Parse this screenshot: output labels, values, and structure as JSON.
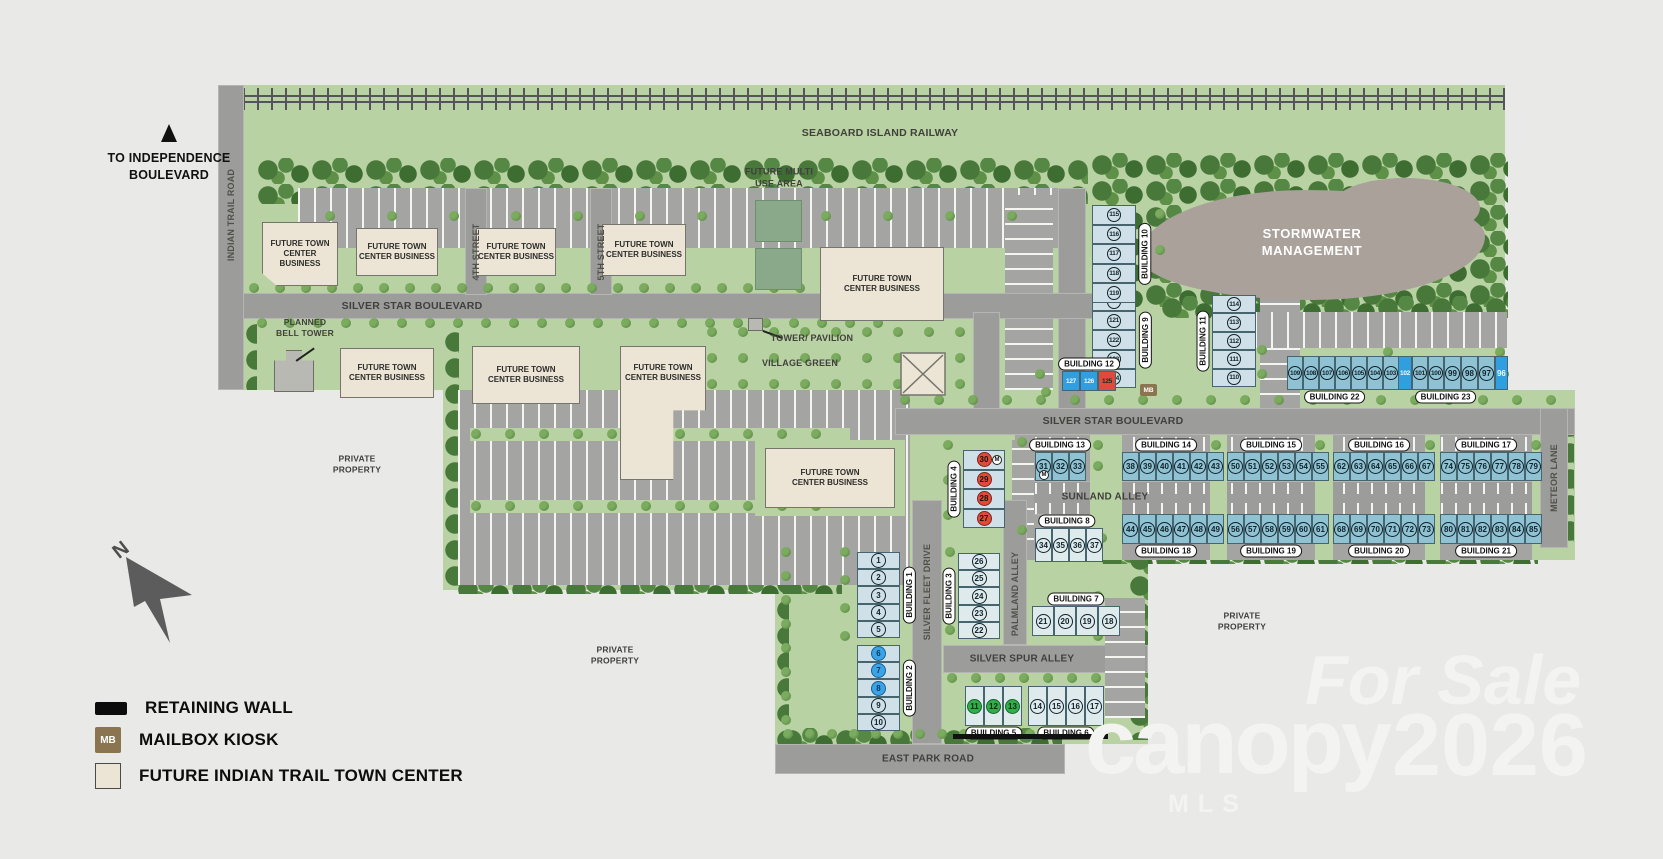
{
  "map": {
    "north_letter": "N",
    "m_marker": "M",
    "mb_abbr": "MB",
    "to_independence_line1": "TO INDEPENDENCE",
    "to_independence_line2": "BOULEVARD",
    "railway": "SEABOARD ISLAND RAILWAY",
    "stormwater_line1": "STORMWATER",
    "stormwater_line2": "MANAGEMENT",
    "village_green": "VILLAGE GREEN",
    "tower_pavilion": "TOWER/ PAVILION",
    "future_multi_line1": "FUTURE MULTI",
    "future_multi_line2": "USE AREA",
    "planned_bell_line1": "PLANNED",
    "planned_bell_line2": "BELL TOWER",
    "future_business_line1": "FUTURE TOWN",
    "future_business_line2": "CENTER BUSINESS",
    "private_property_line1": "PRIVATE",
    "private_property_line2": "PROPERTY"
  },
  "roads": {
    "indian_trail": "INDIAN TRAIL ROAD",
    "silver_star": "SILVER STAR BOULEVARD",
    "fourth": "4TH STREET",
    "fifth": "5TH STREET",
    "sunland": "SUNLAND ALLEY",
    "silver_fleet": "SILVER FLEET DRIVE",
    "palmland": "PALMLAND ALLEY",
    "silver_spur": "SILVER SPUR ALLEY",
    "east_park": "EAST PARK ROAD",
    "meteor": "METEOR LANE"
  },
  "legend": {
    "retaining_wall": "RETAINING WALL",
    "mailbox_kiosk": "MAILBOX KIOSK",
    "future_center": "FUTURE INDIAN TRAIL TOWN CENTER"
  },
  "watermark": {
    "for_sale": "For Sale",
    "brand": "canopy",
    "mls": "MLS",
    "year": "2026"
  },
  "colors": {
    "background": "#e9e9e7",
    "site_green": "#b9d2a3",
    "road_gray": "#9c9c9a",
    "building_beige": "#ece5d5",
    "lot_teal": "#8fc2d3",
    "lot_light_blue": "#cfe0e8",
    "highlight_blue": "#2f9fe0",
    "highlight_red": "#e04a38",
    "highlight_green": "#2fae4a",
    "stormwater_gray": "#a9a19a",
    "mailbox_brown": "#8a7550"
  },
  "buildings": [
    {
      "id": 1,
      "label": "BUILDING 1",
      "lots": [
        {
          "n": "1"
        },
        {
          "n": "2"
        },
        {
          "n": "3"
        },
        {
          "n": "4"
        },
        {
          "n": "5"
        }
      ]
    },
    {
      "id": 2,
      "label": "BUILDING 2",
      "lots": [
        {
          "n": "6",
          "status": "blue"
        },
        {
          "n": "7",
          "status": "blue"
        },
        {
          "n": "8",
          "status": "blue"
        },
        {
          "n": "9"
        },
        {
          "n": "10"
        }
      ]
    },
    {
      "id": 3,
      "label": "BUILDING 3",
      "lots": [
        {
          "n": "26"
        },
        {
          "n": "25"
        },
        {
          "n": "24"
        },
        {
          "n": "23"
        },
        {
          "n": "22"
        }
      ]
    },
    {
      "id": 4,
      "label": "BUILDING 4",
      "lots": [
        {
          "n": "30",
          "status": "red",
          "m": true
        },
        {
          "n": "29",
          "status": "red"
        },
        {
          "n": "28",
          "status": "red"
        },
        {
          "n": "27",
          "status": "red"
        }
      ]
    },
    {
      "id": 5,
      "label": "BUILDING 5",
      "lots": [
        {
          "n": "11",
          "status": "green"
        },
        {
          "n": "12",
          "status": "green"
        },
        {
          "n": "13",
          "status": "green"
        }
      ]
    },
    {
      "id": 6,
      "label": "BUILDING 6",
      "lots": [
        {
          "n": "14"
        },
        {
          "n": "15"
        },
        {
          "n": "16"
        },
        {
          "n": "17"
        }
      ]
    },
    {
      "id": 7,
      "label": "BUILDING 7",
      "lots": [
        {
          "n": "21"
        },
        {
          "n": "20"
        },
        {
          "n": "19"
        },
        {
          "n": "18"
        }
      ]
    },
    {
      "id": 8,
      "label": "BUILDING 8",
      "lots": [
        {
          "n": "34"
        },
        {
          "n": "35"
        },
        {
          "n": "36"
        },
        {
          "n": "37"
        }
      ]
    },
    {
      "id": 9,
      "label": "BUILDING 9",
      "lots": [
        {
          "n": "120"
        },
        {
          "n": "121"
        },
        {
          "n": "122"
        },
        {
          "n": "123"
        },
        {
          "n": "124"
        }
      ]
    },
    {
      "id": 10,
      "label": "BUILDING 10",
      "lots": [
        {
          "n": "115"
        },
        {
          "n": "116"
        },
        {
          "n": "117"
        },
        {
          "n": "118"
        },
        {
          "n": "119"
        }
      ]
    },
    {
      "id": 11,
      "label": "BUILDING 11",
      "lots": [
        {
          "n": "114"
        },
        {
          "n": "113"
        },
        {
          "n": "112"
        },
        {
          "n": "111"
        },
        {
          "n": "110"
        }
      ]
    },
    {
      "id": 12,
      "label": "BUILDING 12",
      "lots": [
        {
          "n": "127",
          "status": "bluecell"
        },
        {
          "n": "126",
          "status": "bluecell"
        },
        {
          "n": "125",
          "status": "redcell"
        }
      ]
    },
    {
      "id": 13,
      "label": "BUILDING 13",
      "lots": [
        {
          "n": "31",
          "m": true
        },
        {
          "n": "32"
        },
        {
          "n": "33"
        }
      ]
    },
    {
      "id": 14,
      "label": "BUILDING 14",
      "lots": [
        {
          "n": "38"
        },
        {
          "n": "39"
        },
        {
          "n": "40"
        },
        {
          "n": "41"
        },
        {
          "n": "42"
        },
        {
          "n": "43"
        }
      ]
    },
    {
      "id": 15,
      "label": "BUILDING 15",
      "lots": [
        {
          "n": "50"
        },
        {
          "n": "51"
        },
        {
          "n": "52"
        },
        {
          "n": "53"
        },
        {
          "n": "54"
        },
        {
          "n": "55"
        }
      ]
    },
    {
      "id": 16,
      "label": "BUILDING 16",
      "lots": [
        {
          "n": "62"
        },
        {
          "n": "63"
        },
        {
          "n": "64"
        },
        {
          "n": "65"
        },
        {
          "n": "66"
        },
        {
          "n": "67"
        }
      ]
    },
    {
      "id": 17,
      "label": "BUILDING 17",
      "lots": [
        {
          "n": "74"
        },
        {
          "n": "75"
        },
        {
          "n": "76"
        },
        {
          "n": "77"
        },
        {
          "n": "78"
        },
        {
          "n": "79"
        }
      ]
    },
    {
      "id": 18,
      "label": "BUILDING 18",
      "lots": [
        {
          "n": "44"
        },
        {
          "n": "45"
        },
        {
          "n": "46"
        },
        {
          "n": "47"
        },
        {
          "n": "48"
        },
        {
          "n": "49"
        }
      ]
    },
    {
      "id": 19,
      "label": "BUILDING 19",
      "lots": [
        {
          "n": "56"
        },
        {
          "n": "57"
        },
        {
          "n": "58"
        },
        {
          "n": "59"
        },
        {
          "n": "60"
        },
        {
          "n": "61"
        }
      ]
    },
    {
      "id": 20,
      "label": "BUILDING 20",
      "lots": [
        {
          "n": "68"
        },
        {
          "n": "69"
        },
        {
          "n": "70"
        },
        {
          "n": "71"
        },
        {
          "n": "72"
        },
        {
          "n": "73"
        }
      ]
    },
    {
      "id": 21,
      "label": "BUILDING 21",
      "lots": [
        {
          "n": "80"
        },
        {
          "n": "81"
        },
        {
          "n": "82"
        },
        {
          "n": "83"
        },
        {
          "n": "84"
        },
        {
          "n": "85"
        }
      ]
    },
    {
      "id": 22,
      "label": "BUILDING 22",
      "lots": [
        {
          "n": "109"
        },
        {
          "n": "108"
        },
        {
          "n": "107"
        },
        {
          "n": "106"
        },
        {
          "n": "105"
        },
        {
          "n": "104"
        },
        {
          "n": "103"
        }
      ]
    },
    {
      "id": 23,
      "label": "BUILDING 23",
      "lots": [
        {
          "n": "102",
          "status": "bluecell"
        },
        {
          "n": "101"
        },
        {
          "n": "100"
        },
        {
          "n": "99"
        },
        {
          "n": "98"
        },
        {
          "n": "97"
        },
        {
          "n": "96",
          "status": "bluecell"
        }
      ]
    }
  ]
}
